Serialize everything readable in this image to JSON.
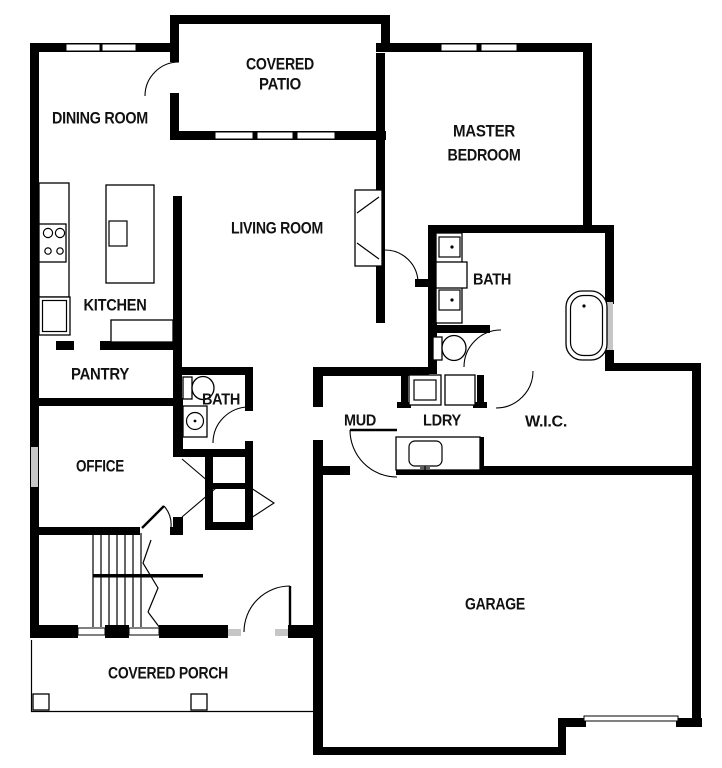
{
  "title": "House floor plan",
  "colors": {
    "wall": "#000000",
    "background": "#ffffff",
    "window_glass": "#c6c6c6",
    "text": "#111111"
  },
  "rooms": [
    {
      "id": "covered-patio",
      "lines": [
        "COVERED",
        "PATIO"
      ]
    },
    {
      "id": "dining-room",
      "lines": [
        "DINING ROOM"
      ]
    },
    {
      "id": "master-bedroom",
      "lines": [
        "MASTER",
        "BEDROOM"
      ]
    },
    {
      "id": "living-room",
      "lines": [
        "LIVING ROOM"
      ]
    },
    {
      "id": "kitchen",
      "lines": [
        "KITCHEN"
      ]
    },
    {
      "id": "pantry",
      "lines": [
        "PANTRY"
      ]
    },
    {
      "id": "hall-bath",
      "lines": [
        "BATH"
      ]
    },
    {
      "id": "office",
      "lines": [
        "OFFICE"
      ]
    },
    {
      "id": "master-bath",
      "lines": [
        "BATH"
      ]
    },
    {
      "id": "mud-room",
      "lines": [
        "MUD"
      ]
    },
    {
      "id": "laundry",
      "lines": [
        "LDRY"
      ]
    },
    {
      "id": "walk-in-closet",
      "lines": [
        "W.I.C."
      ]
    },
    {
      "id": "garage",
      "lines": [
        "GARAGE"
      ]
    },
    {
      "id": "covered-porch",
      "lines": [
        "COVERED PORCH"
      ]
    }
  ],
  "fixtures": [
    {
      "id": "cooktop"
    },
    {
      "id": "refrigerator"
    },
    {
      "id": "kitchen-island"
    },
    {
      "id": "island-sink"
    },
    {
      "id": "bar-counter"
    },
    {
      "id": "media-niche"
    },
    {
      "id": "master-vanity-double-sink"
    },
    {
      "id": "master-toilet"
    },
    {
      "id": "bathtub"
    },
    {
      "id": "hall-toilet"
    },
    {
      "id": "hall-sink"
    },
    {
      "id": "washer"
    },
    {
      "id": "dryer"
    },
    {
      "id": "laundry-sink"
    },
    {
      "id": "stairs"
    },
    {
      "id": "front-door"
    },
    {
      "id": "garage-door"
    },
    {
      "id": "porch-posts"
    },
    {
      "id": "windows"
    }
  ]
}
